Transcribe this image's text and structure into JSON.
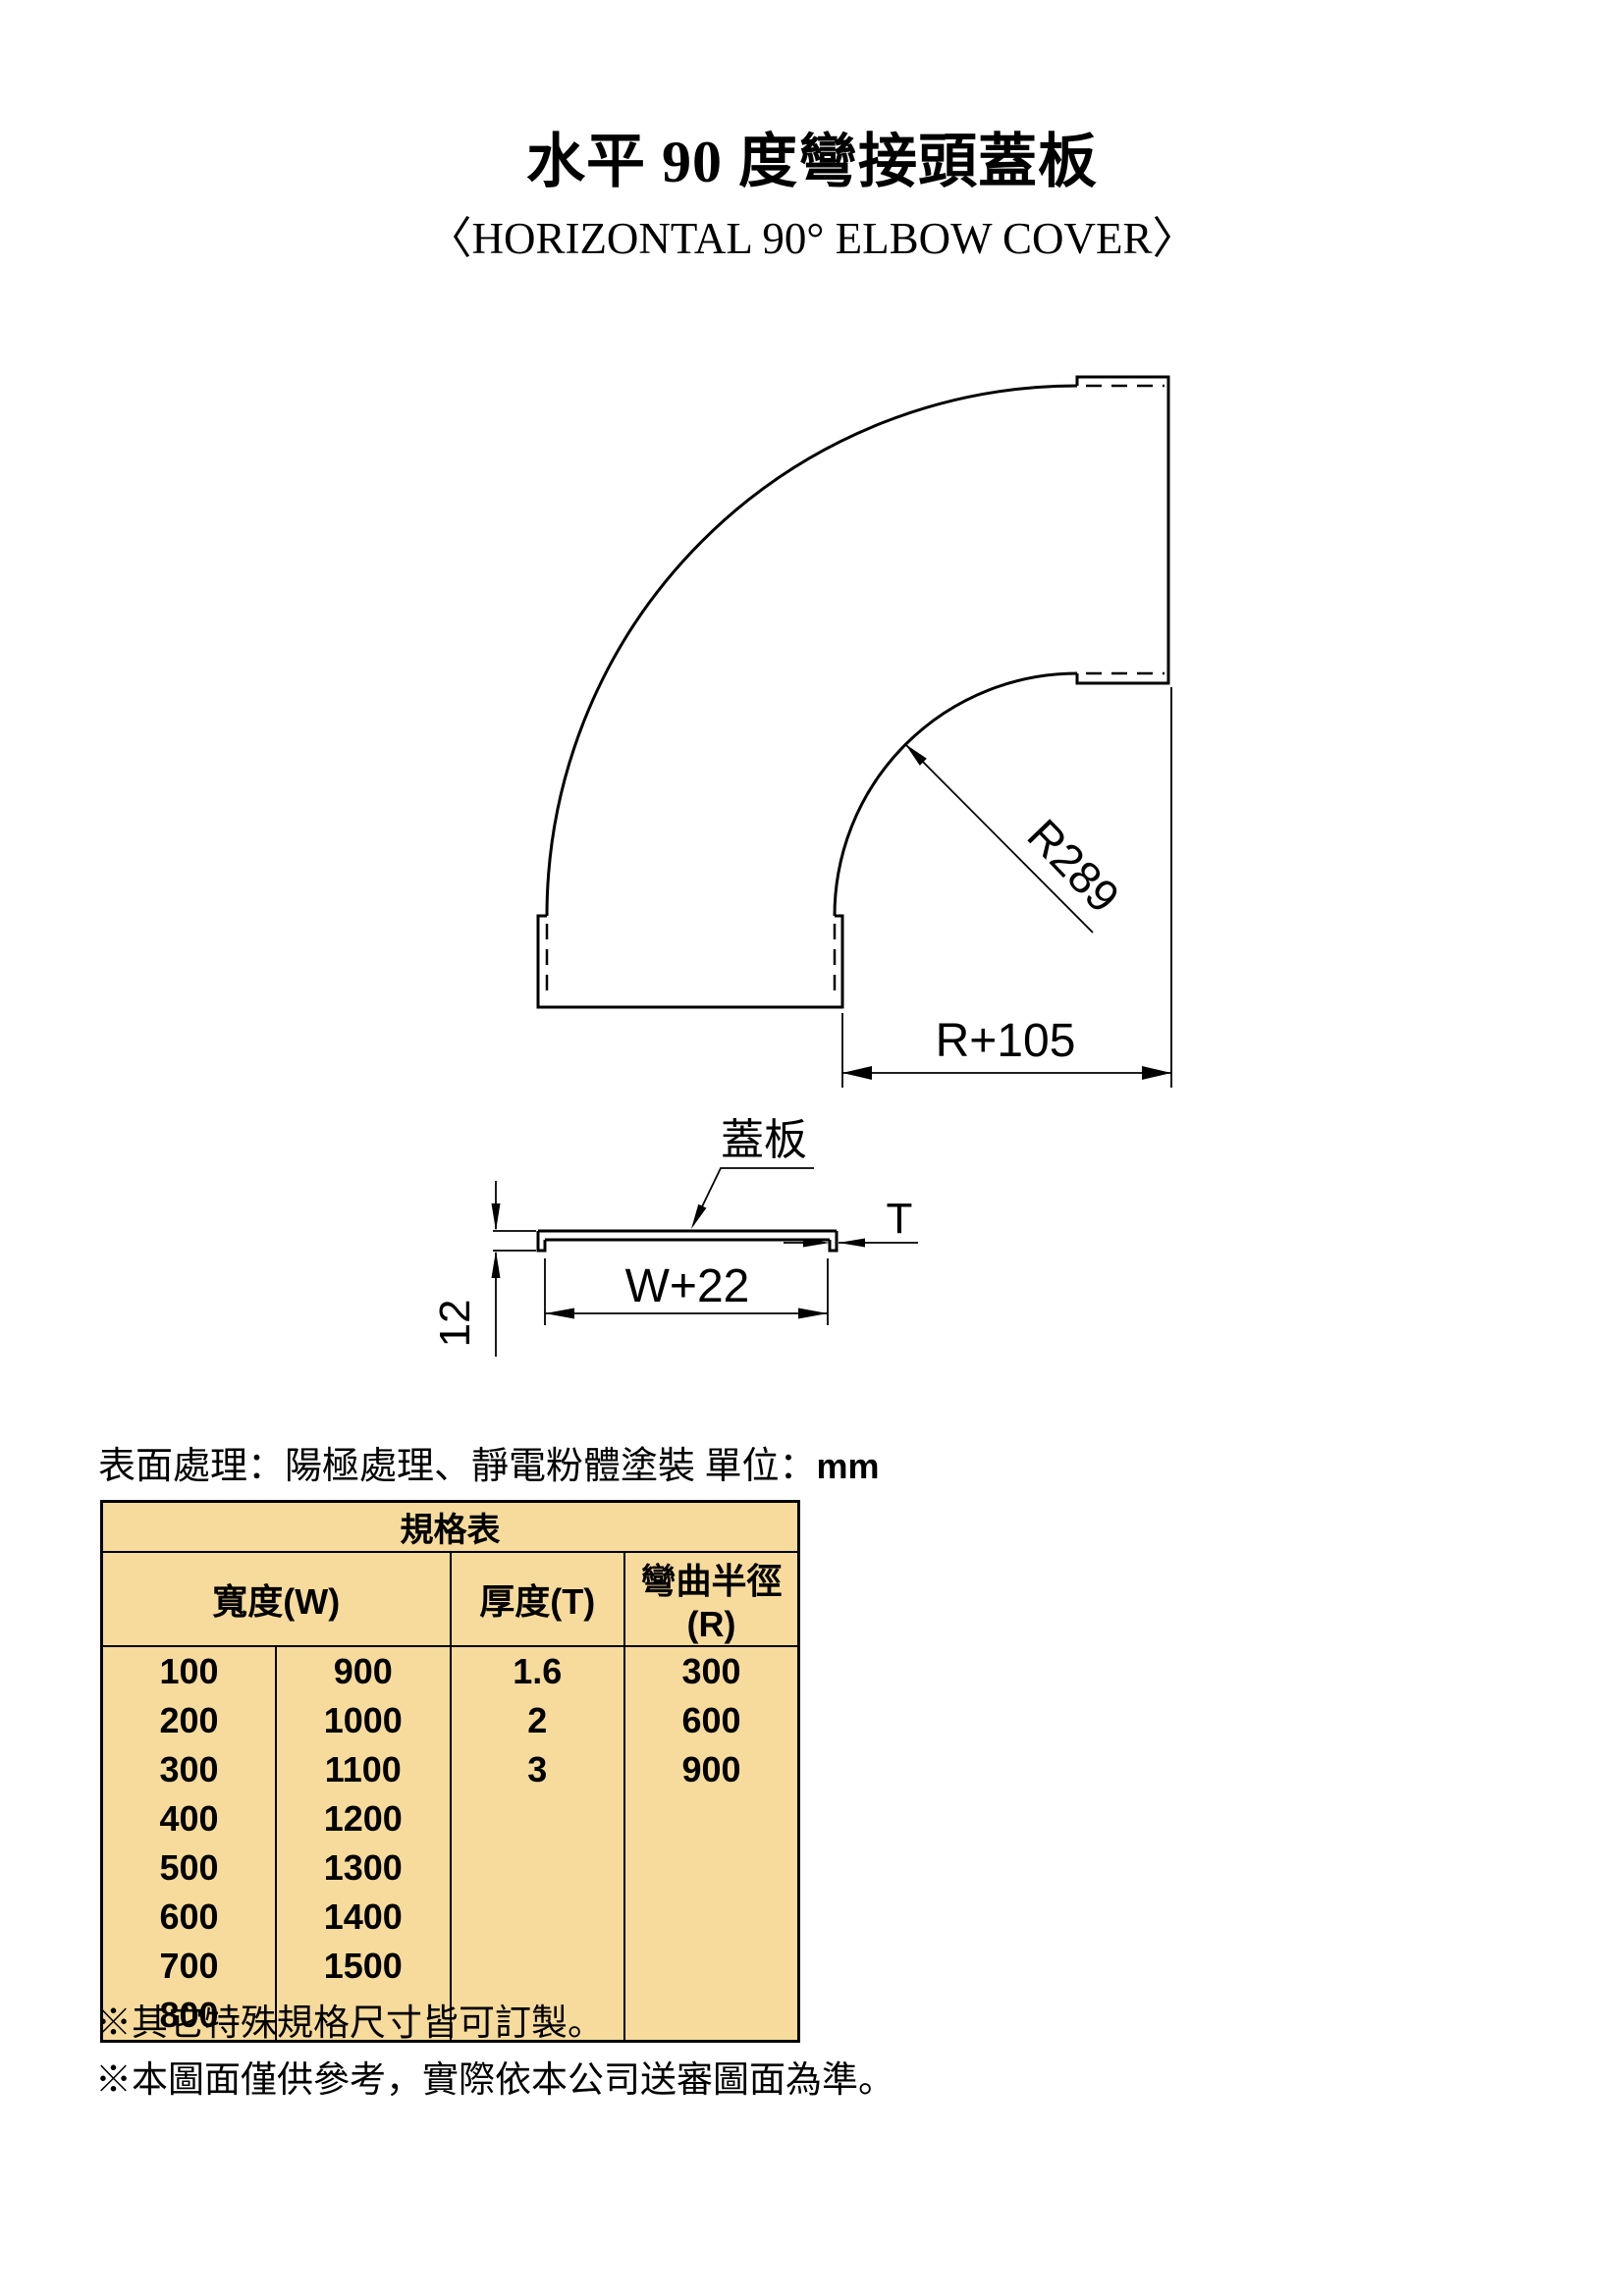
{
  "page": {
    "title": "水平 90 度彎接頭蓋板",
    "subtitle": "〈HORIZONTAL 90°  ELBOW COVER〉"
  },
  "elbow_view": {
    "inner_radius_label": "R289",
    "outer_width_label": "R+105"
  },
  "section_view": {
    "cover_label": "蓋板",
    "thickness_label": "T",
    "width_label": "W+22",
    "lip_height_label": "12"
  },
  "surface_note": {
    "text": "表面處理：陽極處理、靜電粉體塗裝 單位：",
    "unit": "mm"
  },
  "spec_table": {
    "title": "規格表",
    "headers": {
      "width": "寬度(W)",
      "thickness": "厚度(T)",
      "bend_radius": "彎曲半徑(R)"
    },
    "rows": [
      [
        "100",
        "900",
        "1.6",
        "300"
      ],
      [
        "200",
        "1000",
        "2",
        "600"
      ],
      [
        "300",
        "1100",
        "3",
        "900"
      ],
      [
        "400",
        "1200",
        "",
        ""
      ],
      [
        "500",
        "1300",
        "",
        ""
      ],
      [
        "600",
        "1400",
        "",
        ""
      ],
      [
        "700",
        "1500",
        "",
        ""
      ],
      [
        "800",
        "",
        "",
        ""
      ]
    ]
  },
  "notes": [
    "※其它特殊規格尺寸皆可訂製。",
    "※本圖面僅供參考，實際依本公司送審圖面為準。"
  ],
  "colors": {
    "table_background": "#F6DB9C",
    "line_color": "#000000",
    "page_background": "#FFFFFF"
  }
}
